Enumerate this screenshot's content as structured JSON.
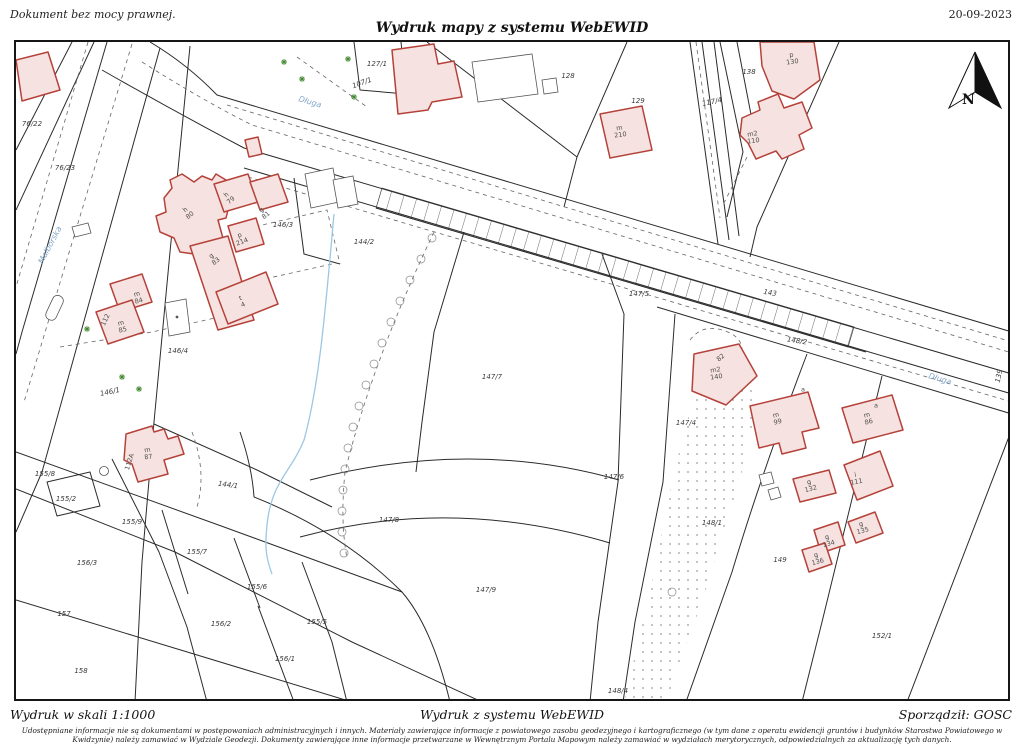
{
  "header": {
    "note": "Dokument bez mocy prawnej.",
    "title": "Wydruk mapy z systemu WebEWID",
    "date": "20-09-2023"
  },
  "footer": {
    "scale": "Wydruk w skali 1:1000",
    "center": "Wydruk z systemu WebEWID",
    "author": "Sporządził: GOSC",
    "disclaimer": "Udostępniane informacje nie są dokumentami w postępowaniach administracyjnych i innych. Materiały zawierające informacje z powiatowego zasobu geodezyjnego i kartograficznego (w tym dane z operatu ewidencji gruntów i budynków Starostwa Powiatowego w Kwidzynie) należy zamawiać w Wydziale Geodezji. Dokumenty zawierające inne informacje przetwarzane w Wewnętrznym Portalu Mapowym należy zamawiać w wydziałach merytorycznych, odpowiedzialnych za aktualizację tych danych."
  },
  "map": {
    "north_label": "N",
    "colors": {
      "building_fill": "#f6e2e0",
      "building_stroke": "#b5423a",
      "street_name": "#84a7cb",
      "stream": "#9cc7e4",
      "linework": "#2b2b2b"
    },
    "streets": [
      {
        "name": "Malborska"
      },
      {
        "name": "Długa"
      },
      {
        "name": "Długa"
      }
    ],
    "parcels": [
      {
        "number": "76/22"
      },
      {
        "number": "76/23"
      },
      {
        "number": "107/1"
      },
      {
        "number": "127/1"
      },
      {
        "number": "128"
      },
      {
        "number": "129"
      },
      {
        "number": "117/4"
      },
      {
        "number": "138"
      },
      {
        "number": "144/2"
      },
      {
        "number": "146/3"
      },
      {
        "number": "146/4"
      },
      {
        "number": "146/1"
      },
      {
        "number": "147/5"
      },
      {
        "number": "147/7"
      },
      {
        "number": "143"
      },
      {
        "number": "148/2"
      },
      {
        "number": "139"
      },
      {
        "number": "147/4"
      },
      {
        "number": "147/6"
      },
      {
        "number": "148/1"
      },
      {
        "number": "149"
      },
      {
        "number": "148/4"
      },
      {
        "number": "152/1"
      },
      {
        "number": "144/1"
      },
      {
        "number": "155/8"
      },
      {
        "number": "155/2"
      },
      {
        "number": "155/9"
      },
      {
        "number": "155/7"
      },
      {
        "number": "156/3"
      },
      {
        "number": "157"
      },
      {
        "number": "158"
      },
      {
        "number": "156/2"
      },
      {
        "number": "155/6"
      },
      {
        "number": "155/5"
      },
      {
        "number": "156/1"
      },
      {
        "number": "147/8"
      },
      {
        "number": "147/9"
      }
    ],
    "buildings": [
      {
        "label": "h\n80"
      },
      {
        "label": "h\n79"
      },
      {
        "label": "g\n81"
      },
      {
        "label": "p\n214"
      },
      {
        "label": "g\n83"
      },
      {
        "label": "t\n4"
      },
      {
        "label": "m\n84"
      },
      {
        "label": "m\n85"
      },
      {
        "label": "112"
      },
      {
        "label": "m\n87"
      },
      {
        "label": "112A"
      },
      {
        "label": "m\n210"
      },
      {
        "label": "p\n130"
      },
      {
        "label": "m2\n110"
      },
      {
        "label": "82"
      },
      {
        "label": "m2\n140"
      },
      {
        "label": "m\n99"
      },
      {
        "label": "a"
      },
      {
        "label": "m\n86"
      },
      {
        "label": "a"
      },
      {
        "label": "g\n132"
      },
      {
        "label": "i\n111"
      },
      {
        "label": "g\n135"
      },
      {
        "label": "g\n134"
      },
      {
        "label": "g\n136"
      }
    ]
  }
}
